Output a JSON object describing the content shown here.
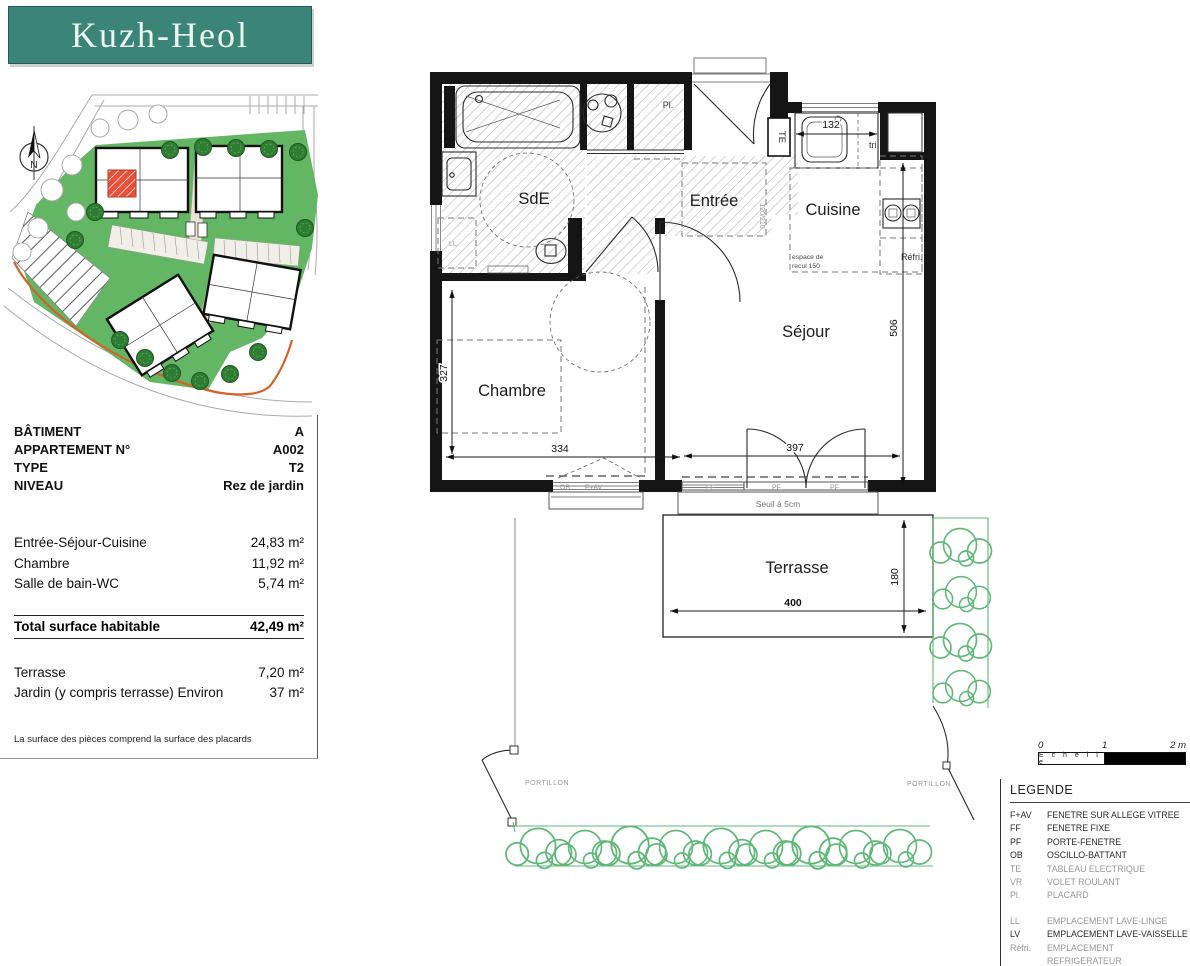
{
  "logo": {
    "title": "Kuzh-Heol"
  },
  "site": {
    "compass_n": "N"
  },
  "info": {
    "rows": [
      {
        "label": "BÂTIMENT",
        "value": "A"
      },
      {
        "label": "APPARTEMENT N°",
        "value": "A002"
      },
      {
        "label": "TYPE",
        "value": "T2"
      },
      {
        "label": "NIVEAU",
        "value": "Rez de jardin"
      }
    ]
  },
  "surfaces": {
    "rooms": [
      {
        "label": "Entrée-Séjour-Cuisine",
        "value": "24,83 m²"
      },
      {
        "label": "Chambre",
        "value": "11,92 m²"
      },
      {
        "label": "Salle de bain-WC",
        "value": "5,74 m²"
      }
    ],
    "total": {
      "label": "Total surface habitable",
      "value": "42,49 m²"
    },
    "exterior": [
      {
        "label": "Terrasse",
        "value": "7,20 m²"
      },
      {
        "label": "Jardin (y compris terrasse) Environ",
        "value": "37 m²"
      }
    ],
    "note": "La surface des pièces comprend la surface des placards"
  },
  "plan": {
    "rooms": {
      "sde": "SdE",
      "entree": "Entrée",
      "cuisine": "Cuisine",
      "sejour": "Séjour",
      "chambre": "Chambre",
      "terrasse": "Terrasse"
    },
    "labels": {
      "pl": "Pl.",
      "te": "TE",
      "tri": "tri",
      "refri": "Réfri.",
      "ll": "LL.",
      "recul1": "espace de",
      "recul2": "recul 150",
      "seuil": "Seuil à 5cm",
      "ob": "OB",
      "fav": "F+AV",
      "ff": "FF",
      "pf1": "PF",
      "pf2": "PF",
      "dim_small": "120/210",
      "portillon_left": "PORTILLON",
      "portillon_right": "PORTILLON"
    },
    "dims": {
      "d327": "327",
      "d334": "334",
      "d397": "397",
      "d506": "506",
      "d132": "132",
      "d400": "400",
      "d180": "180"
    }
  },
  "scalebar": {
    "t0": "0",
    "t1": "1",
    "t2": "2 m",
    "label": "E c h e l l e"
  },
  "legend": {
    "title": "LEGENDE",
    "items": [
      {
        "code": "F+AV",
        "label": "FENETRE SUR ALLEGE VITREE"
      },
      {
        "code": "FF",
        "label": "FENETRE FIXE"
      },
      {
        "code": "PF",
        "label": "PORTE-FENETRE"
      },
      {
        "code": "OB",
        "label": "OSCILLO-BATTANT"
      },
      {
        "code": "TE",
        "label": "TABLEAU ELECTRIQUE"
      },
      {
        "code": "VR",
        "label": "VOLET ROULANT"
      },
      {
        "code": "Pl.",
        "label": "PLACARD"
      }
    ],
    "items2": [
      {
        "code": "LL",
        "label": "EMPLACEMENT LAVE-LINGE"
      },
      {
        "code": "LV",
        "label": "EMPLACEMENT LAVE-VAISSELLE"
      },
      {
        "code": "Réfri.",
        "label": "EMPLACEMENT REFRIGERATEUR"
      },
      {
        "code": "",
        "label": "FAUX-PLAFOND OU SOFFITE"
      }
    ]
  },
  "colors": {
    "brand_teal": "#3a8578",
    "site_green": "#63b764",
    "unit_red": "#e8503a",
    "boundary_orange": "#d2622a",
    "hedge_green": "#5fb878"
  }
}
